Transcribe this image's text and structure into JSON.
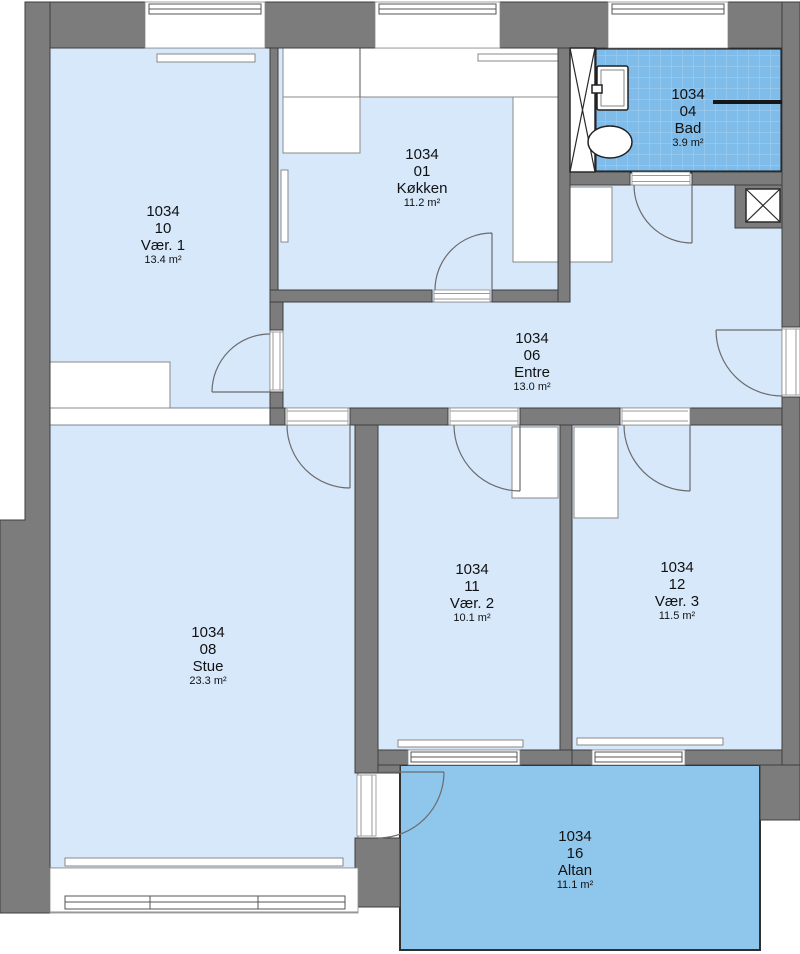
{
  "plan": {
    "unit": "1034",
    "rooms": [
      {
        "id": "1034",
        "number": "10",
        "name": "Vær. 1",
        "area": "13.4 m²"
      },
      {
        "id": "1034",
        "number": "01",
        "name": "Køkken",
        "area": "11.2 m²"
      },
      {
        "id": "1034",
        "number": "04",
        "name": "Bad",
        "area": "3.9 m²"
      },
      {
        "id": "1034",
        "number": "06",
        "name": "Entre",
        "area": "13.0 m²"
      },
      {
        "id": "1034",
        "number": "08",
        "name": "Stue",
        "area": "23.3 m²"
      },
      {
        "id": "1034",
        "number": "11",
        "name": "Vær. 2",
        "area": "10.1 m²"
      },
      {
        "id": "1034",
        "number": "12",
        "name": "Vær. 3",
        "area": "11.5 m²"
      },
      {
        "id": "1034",
        "number": "16",
        "name": "Altan",
        "area": "11.1 m²"
      }
    ],
    "colors": {
      "room_fill": "#d7e8fb",
      "balcony_fill": "#8fc6ec",
      "bath_tile_fill": "#7fbce9",
      "bath_tile_line": "#a6cff1",
      "wall_fill": "#7c7c7c",
      "outline": "#3e3e3e",
      "label_text": "#111111"
    }
  }
}
